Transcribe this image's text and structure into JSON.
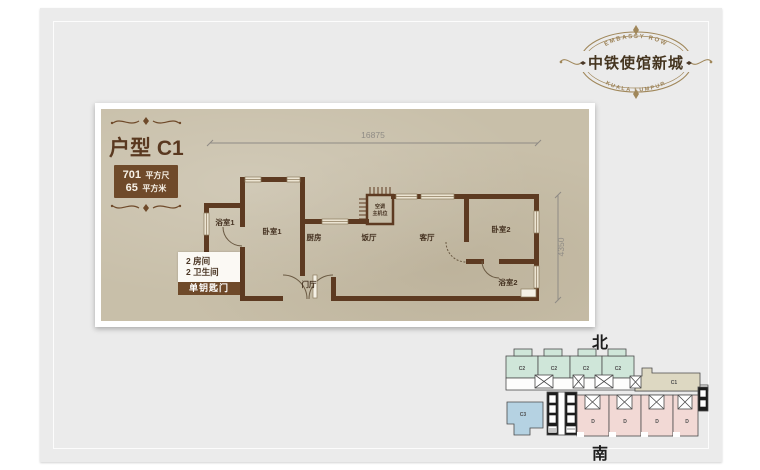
{
  "brand": {
    "name": "中铁使馆新城",
    "tagline_top": "EMBASSY ROW",
    "tagline_bottom": "KUALA LUMPUR"
  },
  "unit": {
    "title": "户型 C1",
    "area_sqft_value": "701",
    "area_sqft_unit": "平方尺",
    "area_sqm_value": "65",
    "area_sqm_unit": "平方米",
    "rooms_line1": "2 房间",
    "rooms_line2": "2 卫生间",
    "key_note": "单钥匙门"
  },
  "plan": {
    "dim_top": "16875",
    "dim_right": "4350",
    "rooms": {
      "bath1": "浴室1",
      "bed1": "卧室1",
      "kitchen": "厨房",
      "dining": "饭厅",
      "living": "客厅",
      "bed2": "卧室2",
      "bath2": "浴室2",
      "foyer": "门厅",
      "ac_line1": "空调",
      "ac_line2": "主机位"
    }
  },
  "key_plan": {
    "north": "北",
    "south": "南",
    "labels": {
      "c2": "C2",
      "c1": "C1",
      "c3": "C3",
      "d": "D"
    }
  },
  "colors": {
    "wall": "#5d3a21",
    "paper": "#c8bfa9",
    "accent_brown": "#6f4a2a",
    "bronze": "#a0875a",
    "c2_fill": "#cfe6d9",
    "c1_fill": "#ddd8c2",
    "c3_fill": "#b5d2e2",
    "d_fill": "#f2d9d5"
  }
}
